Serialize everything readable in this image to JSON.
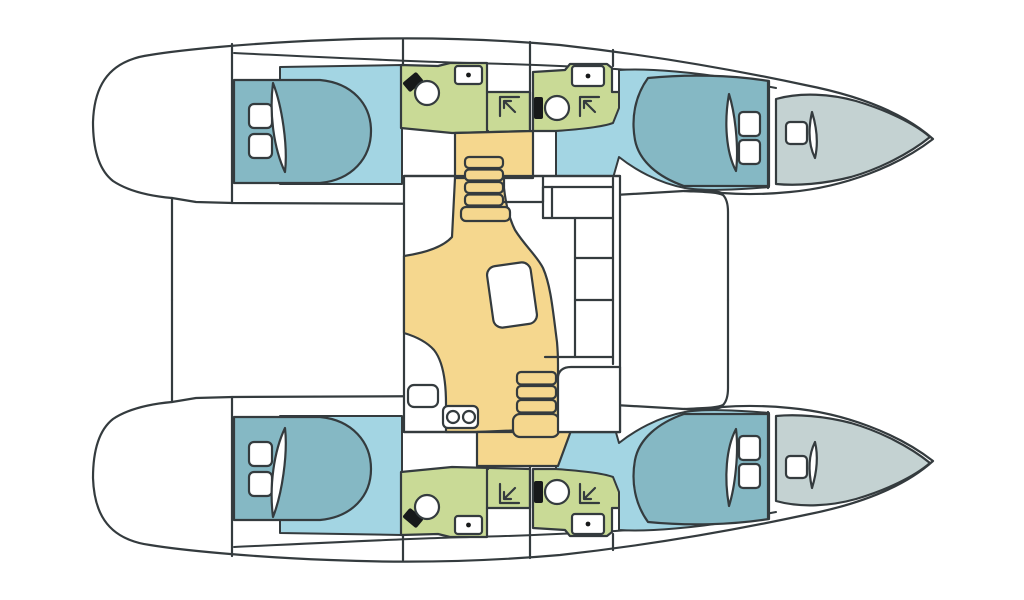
{
  "page": {
    "title": "Catamaran interior deck floor plan (top-down diagram)",
    "orientation": "bow pointing right, twin hulls top and bottom, salon on bridgedeck in the center"
  },
  "colors": {
    "background": "#ffffff",
    "outline": "#343b3e",
    "hull": "#ffffff",
    "cabin_floor": "#a3d5e3",
    "bed": "#85b8c4",
    "bathroom": "#c9da96",
    "salon_floor": "#f5d78e",
    "bow_locker": "#c4d2d2",
    "fixture": "#17191a",
    "white": "#ffffff"
  },
  "regions": [
    {
      "id": "port-aft-cabin",
      "type": "cabin",
      "features": [
        "double-bed",
        "2 pillows"
      ]
    },
    {
      "id": "port-aft-head",
      "type": "bathroom",
      "features": [
        "toilet",
        "sink",
        "shower"
      ]
    },
    {
      "id": "port-forward-head",
      "type": "bathroom",
      "features": [
        "toilet",
        "sink",
        "shower"
      ]
    },
    {
      "id": "port-forward-cabin",
      "type": "cabin",
      "features": [
        "double-bed",
        "2 pillows"
      ]
    },
    {
      "id": "port-bow-locker",
      "type": "storage",
      "features": [
        "hatch"
      ]
    },
    {
      "id": "starboard-aft-cabin",
      "type": "cabin",
      "features": [
        "double-bed",
        "2 pillows"
      ]
    },
    {
      "id": "starboard-aft-head",
      "type": "bathroom",
      "features": [
        "toilet",
        "sink",
        "shower"
      ]
    },
    {
      "id": "starboard-forward-head",
      "type": "bathroom",
      "features": [
        "toilet",
        "sink",
        "shower"
      ]
    },
    {
      "id": "starboard-forward-cabin",
      "type": "cabin",
      "features": [
        "double-bed",
        "2 pillows"
      ]
    },
    {
      "id": "starboard-bow-locker",
      "type": "storage",
      "features": [
        "hatch"
      ]
    },
    {
      "id": "salon",
      "type": "salon",
      "features": [
        "dining-table",
        "L-settee",
        "galley-sink",
        "nav-console"
      ]
    },
    {
      "id": "stairs-port",
      "type": "stairs",
      "steps": 5
    },
    {
      "id": "stairs-starboard",
      "type": "stairs",
      "steps": 4
    }
  ],
  "icon_legend": {
    "toilet-icon": "circle bowl with dark cistern block",
    "sink-icon": "rounded rectangle with center drain dot",
    "shower-icon": "corner lines with diagonal arrow into corner",
    "bed-pillow-icon": "white rounded square",
    "hatch-icon": "white rounded square",
    "galley-faucet-icon": "two circles on counter"
  },
  "counts": {
    "cabins": 4,
    "bathrooms": 4,
    "beds": 4,
    "toilets": 4,
    "sinks": 4,
    "showers": 4,
    "stairways": 2,
    "tables": 1
  }
}
